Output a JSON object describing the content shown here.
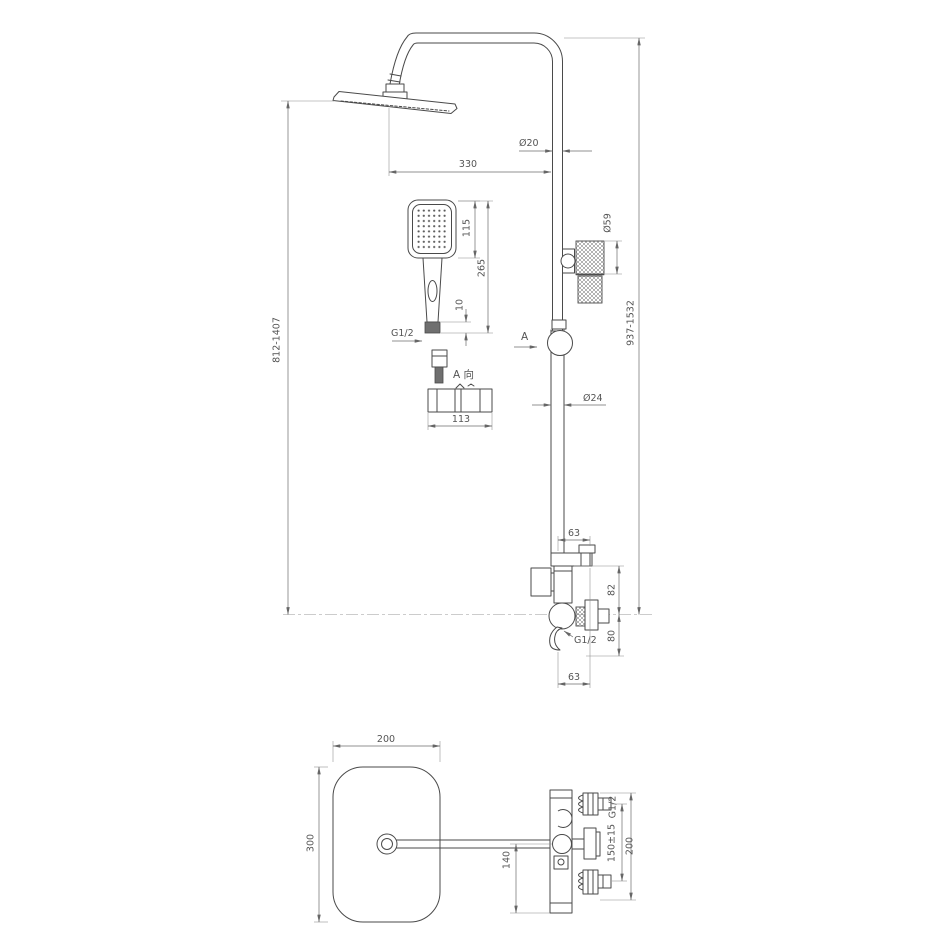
{
  "drawing": {
    "background": "#ffffff",
    "object_line_color": "#4a4a4a",
    "dimension_line_color": "#6b6b6b",
    "text_color": "#555555"
  },
  "front_view": {
    "dims": {
      "top_pipe_diameter": "Ø20",
      "arm_reach": "330",
      "hand_shower_head_length": "115",
      "hand_shower_total_length": "265",
      "hand_shower_collar": "10",
      "hand_shower_thread": "G1/2",
      "section_marker": "A",
      "detail_view_title": "A 向",
      "detail_length": "113",
      "riser_diameter": "Ø24",
      "lock_knob_diameter": "Ø59",
      "overall_height_right": "937-1532",
      "overall_height_left": "812-1407",
      "valve_offset_top": "63",
      "valve_above_axis": "82",
      "valve_below_axis": "80",
      "valve_outlet_thread": "G1/2",
      "valve_offset_bottom": "63"
    }
  },
  "plan_view": {
    "dims": {
      "head_width": "200",
      "head_depth": "300",
      "inlet_thread": "G1/2",
      "inlet_spacing": "150±15",
      "valve_span": "200",
      "body_offset": "140"
    }
  }
}
